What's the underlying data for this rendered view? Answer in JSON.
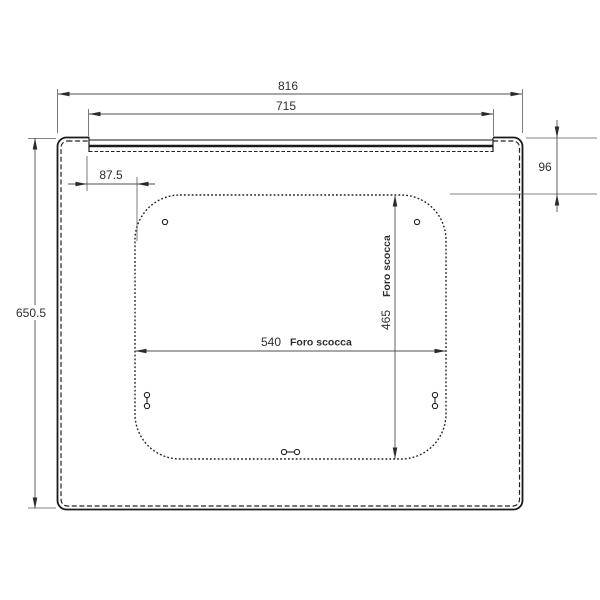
{
  "drawing": {
    "type": "technical-dimension-drawing",
    "subject": "panel with rear body cutout (foro scocca)",
    "language": "Italian",
    "colors": {
      "background": "#ffffff",
      "outline": "#1a1a1a",
      "dimension_lines": "#4f4f4f",
      "text": "#2e2e2e"
    },
    "dimensions": {
      "overall_width": {
        "value": "816",
        "unit_hint": "mm",
        "orientation": "horizontal"
      },
      "glass_width": {
        "value": "715",
        "unit_hint": "mm",
        "orientation": "horizontal"
      },
      "overall_height": {
        "value": "650.5",
        "unit_hint": "mm",
        "orientation": "vertical"
      },
      "top_offset": {
        "value": "96",
        "unit_hint": "mm",
        "orientation": "vertical"
      },
      "side_offset": {
        "value": "87.5",
        "unit_hint": "mm",
        "orientation": "horizontal"
      },
      "cutout_width": {
        "value": "540",
        "note": "Foro scocca",
        "orientation": "horizontal"
      },
      "cutout_height": {
        "value": "465",
        "note": "Foro scocca",
        "orientation": "vertical"
      }
    },
    "features": {
      "outer_panel": "rounded rectangle, solid outline with inner dashed seal line",
      "top_band": "recessed front trim strip between corner ears",
      "cutout": "dotted rounded rectangle (body cutout)",
      "holes": "2 round holes top, 2 vertical slot holes bottom sides, 1 horizontal slot hole bottom center"
    }
  }
}
